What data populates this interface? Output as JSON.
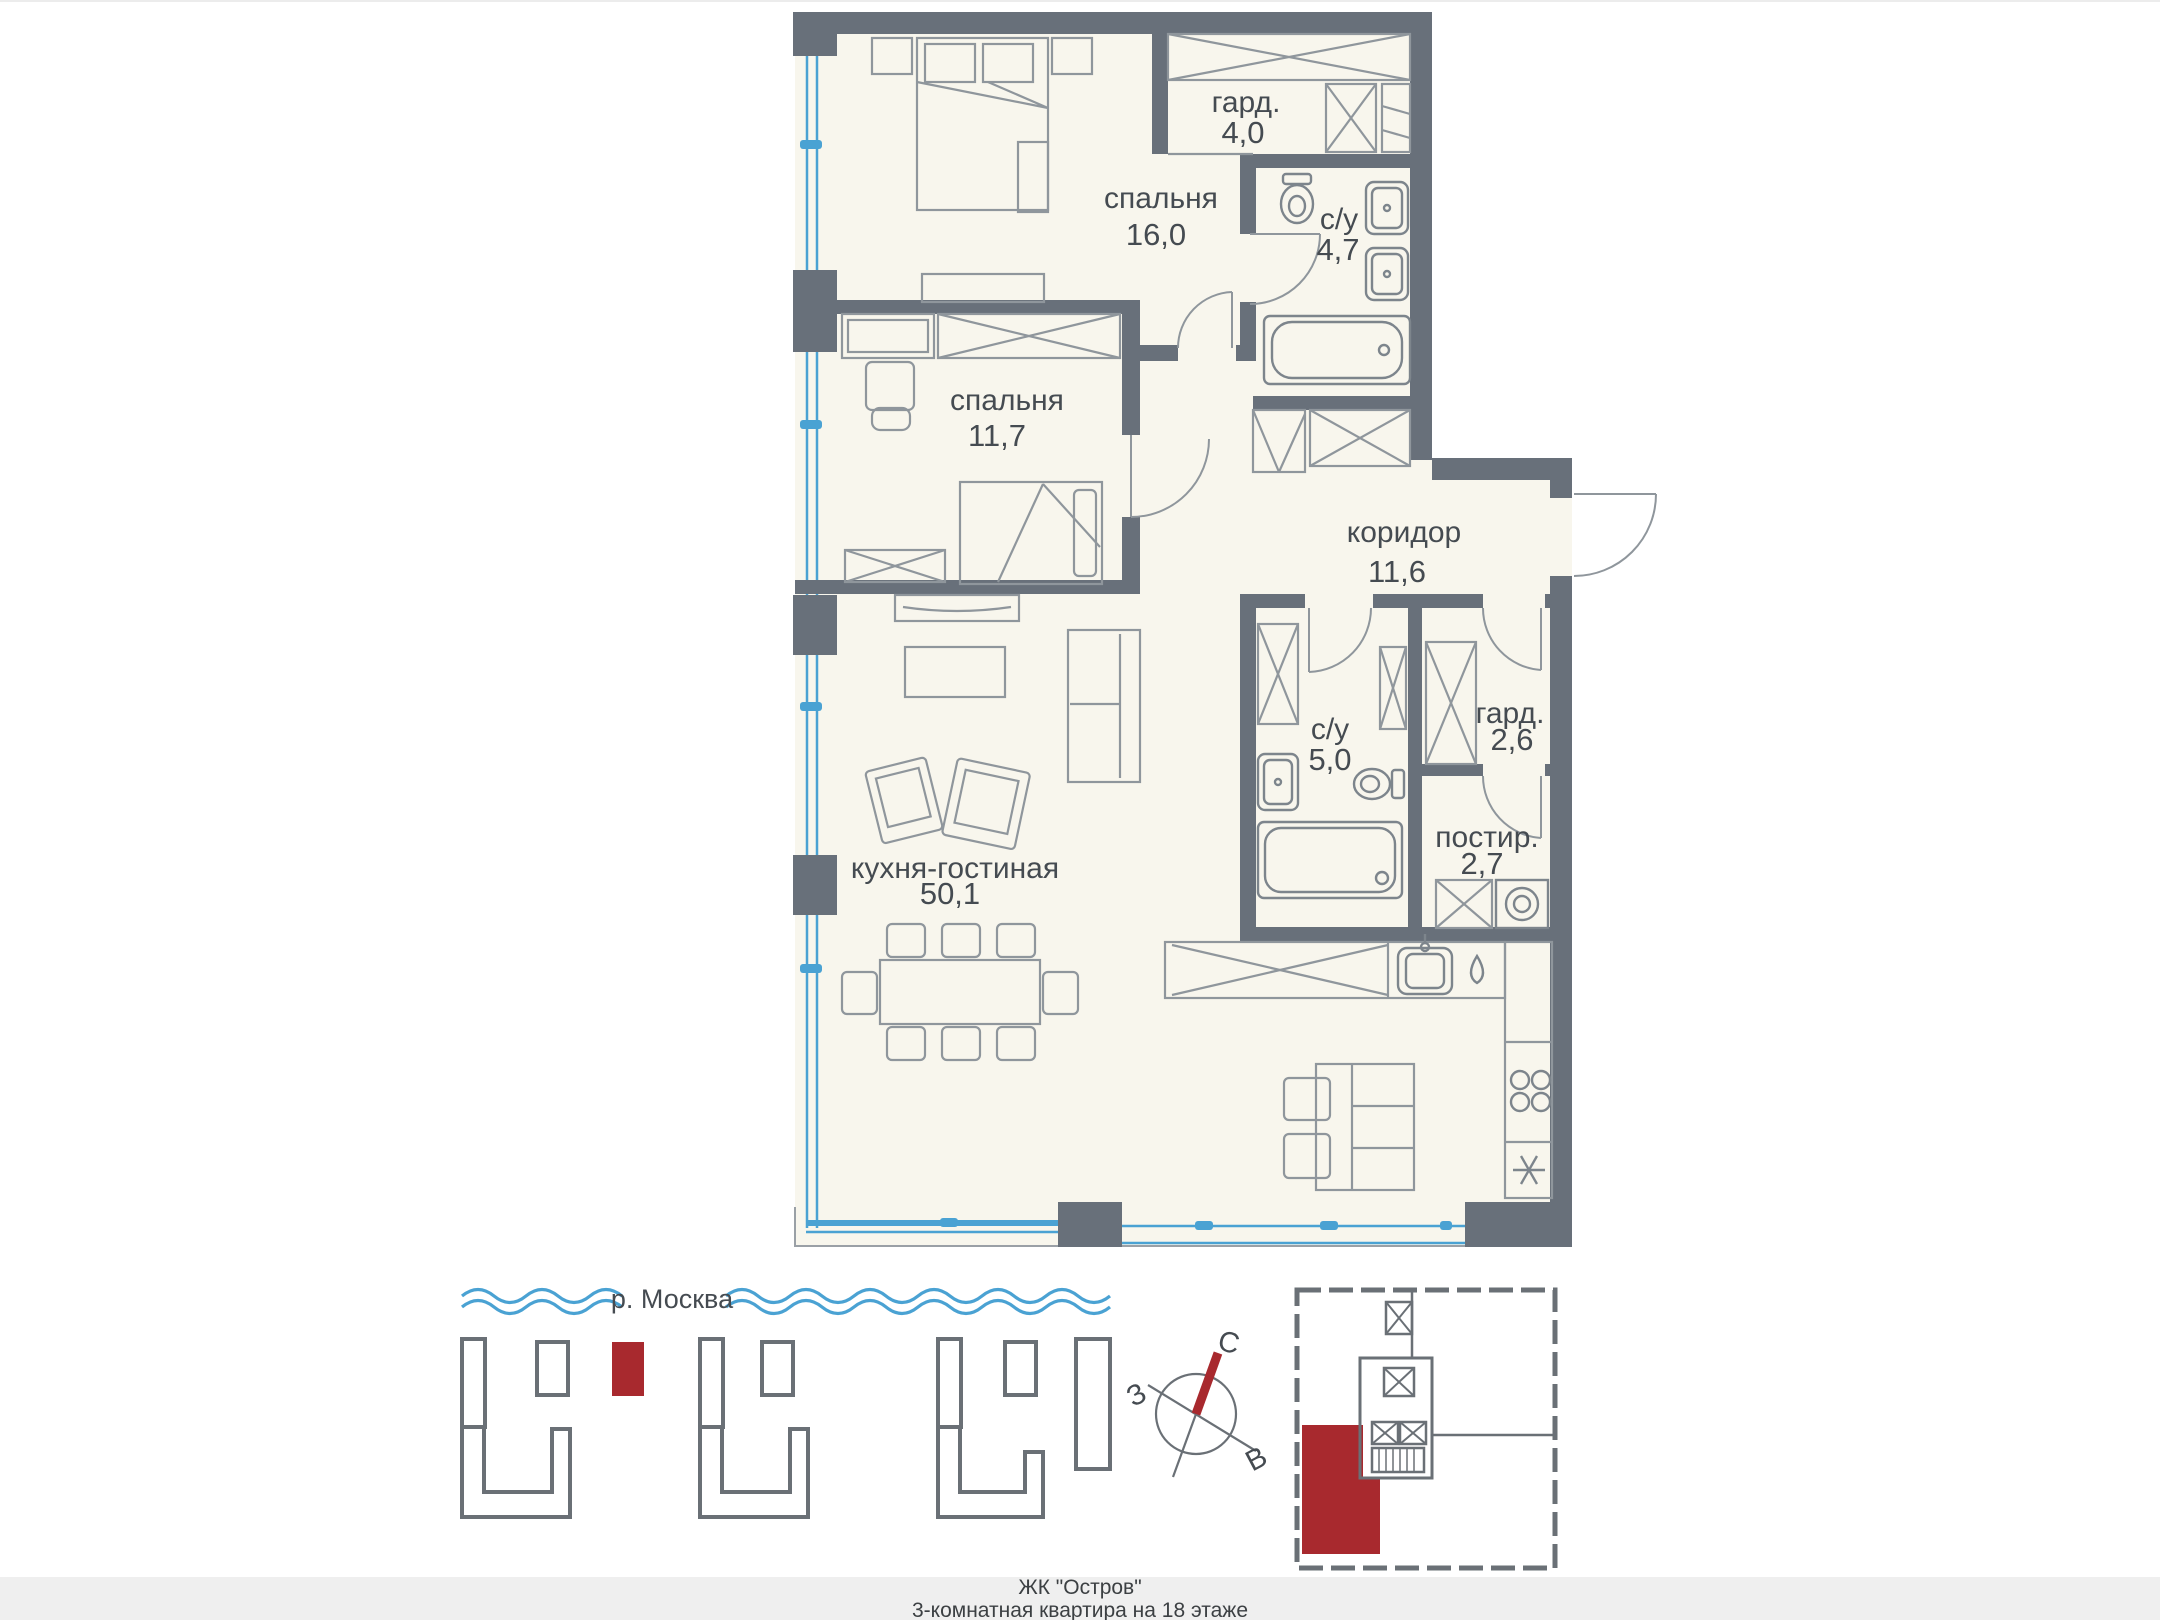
{
  "page": {
    "title_line1": "ЖК \"Остров\"",
    "title_line2": "3-комнатная квартира на 18 этаже"
  },
  "floor_plan": {
    "rooms": [
      {
        "id": "bedroom-1",
        "name": "спальня",
        "area": "16,0"
      },
      {
        "id": "wardrobe-1",
        "name": "гард.",
        "area": "4,0"
      },
      {
        "id": "bathroom-1",
        "name": "с/у",
        "area": "4,7"
      },
      {
        "id": "bedroom-2",
        "name": "спальня",
        "area": "11,7"
      },
      {
        "id": "corridor",
        "name": "коридор",
        "area": "11,6"
      },
      {
        "id": "bathroom-2",
        "name": "с/у",
        "area": "5,0"
      },
      {
        "id": "wardrobe-2",
        "name": "гард.",
        "area": "2,6"
      },
      {
        "id": "laundry",
        "name": "постир.",
        "area": "2,7"
      },
      {
        "id": "kitchen-living",
        "name": "кухня-гостиная",
        "area": "50,1"
      }
    ]
  },
  "site_plan": {
    "river_label": "р. Москва"
  },
  "compass": {
    "north": "С",
    "west": "З",
    "east": "В"
  },
  "colors": {
    "wall": "#68707a",
    "floor": "#f8f6ed",
    "window_blue": "#4aa2d3",
    "accent_red": "#a8292e",
    "label_text": "#454b51",
    "footer_bg": "#efefef"
  }
}
